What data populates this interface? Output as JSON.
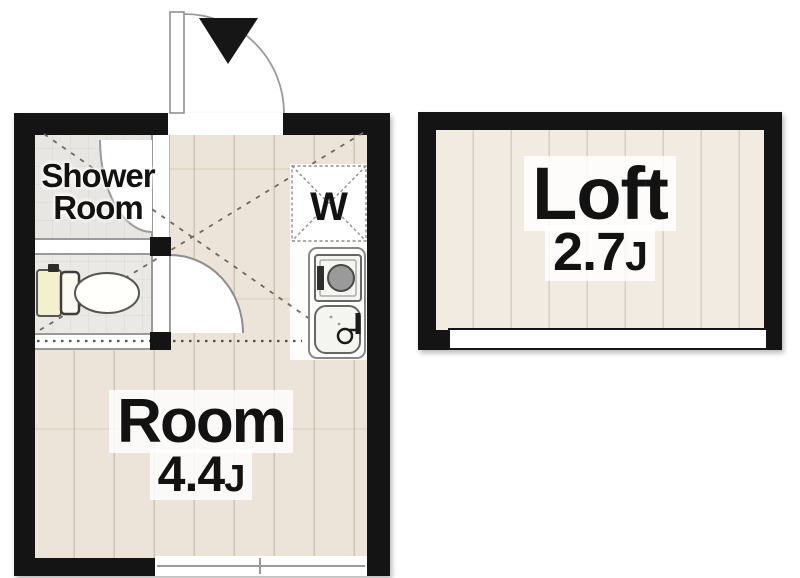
{
  "unit_main": {
    "room": {
      "label": "Room",
      "size": "4.4",
      "size_unit": "J"
    },
    "shower": {
      "label": "Shower Room"
    },
    "washer": {
      "label": "W"
    }
  },
  "loft": {
    "label": "Loft",
    "size": "2.7",
    "size_unit": "J"
  },
  "icons": [
    "entrance-arrow-icon",
    "entrance-door-swing-icon",
    "shower-door-swing-icon",
    "toilet-door-swing-icon",
    "toilet-icon",
    "washer-pan-icon",
    "stove-icon",
    "sink-icon",
    "window-icon",
    "loft-opening-railing"
  ],
  "colors": {
    "wall": "#141414",
    "floor-main": "#ece4d8",
    "floor-loft": "#f2ebe2",
    "floor-wet": "#e7e6e3",
    "line": "#8a8a8a",
    "text": "#121212",
    "halo": "rgba(255,255,255,0.82)",
    "tank": "#f2f0cf"
  }
}
